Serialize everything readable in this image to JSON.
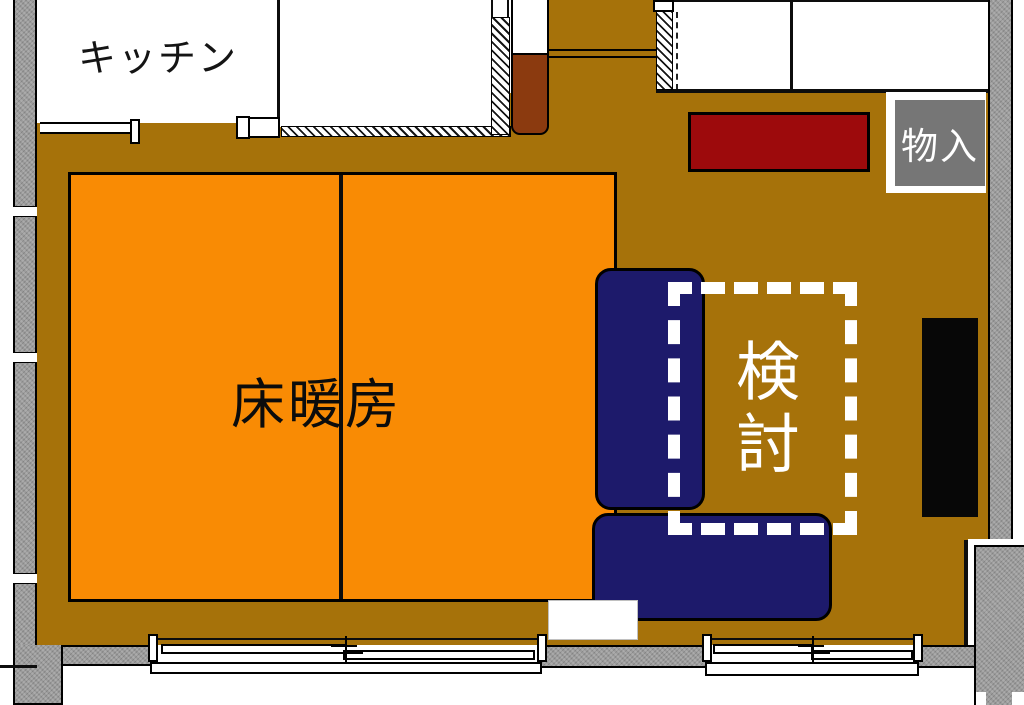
{
  "labels": {
    "kitchen": "キッチン",
    "floor_heating": "床暖房",
    "review": "検討",
    "storage": "物入"
  },
  "colors": {
    "floor_brown": "#A6720A",
    "heat_orange": "#F98B04",
    "sofa_navy": "#1D1A6B",
    "cab_red": "#9D0A0C",
    "box_brown": "#8B3A0F",
    "storage_gray": "#767676",
    "wall_gray": "#9B9B9B",
    "tv_black": "#070707",
    "dash_white": "#FFFFFF",
    "line_black": "#0D0D0D"
  }
}
